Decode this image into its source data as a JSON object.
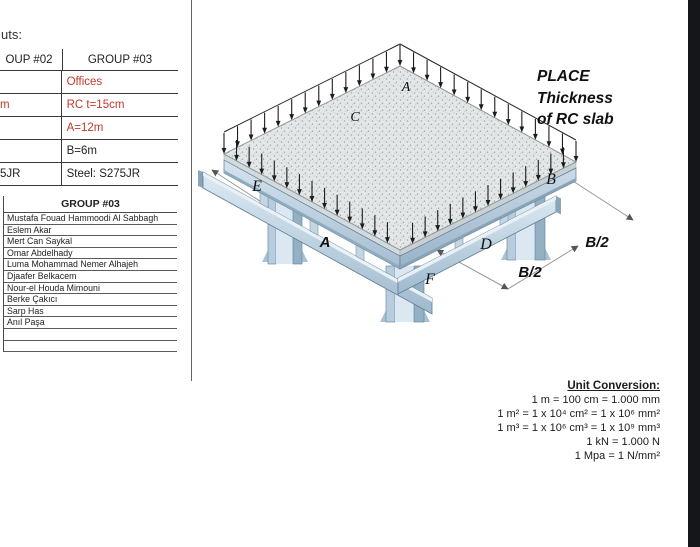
{
  "page": {
    "intro_fragment": "uts:"
  },
  "inputs_table": {
    "headers": {
      "group02": "OUP #02",
      "group03": "GROUP #03"
    },
    "rows": [
      {
        "left": "",
        "right": "Offices"
      },
      {
        "left": "m",
        "right": "RC t=15cm"
      },
      {
        "left": "",
        "right": "A=12m"
      },
      {
        "left": "",
        "right": "B=6m"
      },
      {
        "left": "5JR",
        "right": "Steel: S275JR"
      }
    ]
  },
  "members_table": {
    "header": "GROUP #03",
    "names": [
      "Mustafa Fouad Hammoodi Al Sabbagh",
      "Eslem Akar",
      "Mert Can Saykal",
      "Omar Abdelhady",
      "Luma Mohammad Nemer Alhajeh",
      "Djaafer Belkacem",
      "Nour-el Houda Mimouni",
      "Berke Çakıcı",
      "Sarp Has",
      "Anıl Paşa"
    ]
  },
  "diagram": {
    "note_line1": "PLACE",
    "note_line2": "Thickness",
    "note_line3": "of RC slab",
    "labels": {
      "slab_point_a": "A",
      "slab_point_c": "C",
      "point_e": "E",
      "point_b": "B",
      "bay_a": "A",
      "point_d": "D",
      "point_f": "F",
      "dim_b2_upper": "B/2",
      "dim_b2_lower": "B/2"
    }
  },
  "unit_conversion": {
    "title": "Unit Conversion:",
    "lines": [
      "1 m = 100 cm = 1.000 mm",
      "1 m² = 1 x 10⁴ cm² = 1 x 10⁶ mm²",
      "1 m³ = 1 x 10⁶ cm³ = 1 x 10⁹ mm³",
      "1 kN = 1.000 N",
      "1 Mpa = 1 N/mm²"
    ]
  },
  "colors": {
    "accent_red": "#c0392b",
    "steel_light": "#dbe8f1",
    "steel_mid": "#aac4d6",
    "steel_dark": "#8aa6ba",
    "slab_fill": "#e4e7e8"
  }
}
